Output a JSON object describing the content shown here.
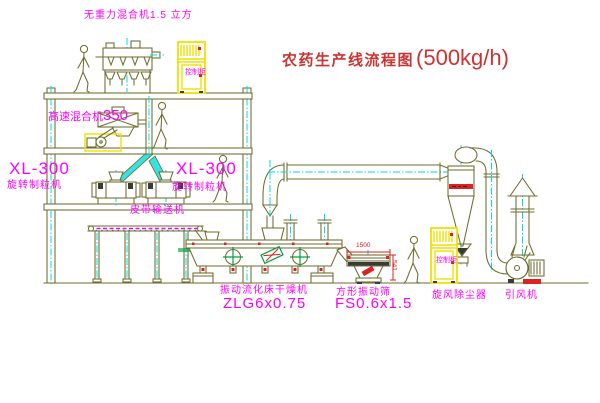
{
  "title": {
    "text": "农药生产线流程图",
    "capacity": "(500kg/h)"
  },
  "labels": {
    "gravity_mixer": "无重力混合机1.5 立方",
    "highspeed_mixer_name": "高速混合机",
    "highspeed_mixer_size": "350",
    "granulator_left_model": "XL-300",
    "granulator_left_name": "旋转制粒机",
    "granulator_center_model": "XL-300",
    "granulator_center_name": "旋转制粒机",
    "belt_conveyor": "皮带输送机",
    "dryer_name": "振动流化床干燥机",
    "dryer_model": "ZLG6x0.75",
    "sieve_name": "方形振动筛",
    "sieve_model": "FS0.6x1.5",
    "cyclone": "旋风除尘器",
    "induced_draft_fan": "引风机",
    "cabinet_top": "控制柜",
    "cabinet_bottom": "控制柜"
  },
  "dimensions": {
    "sieve_length": "1500",
    "sieve_height": "541"
  },
  "colors": {
    "line": "#6d6d2e",
    "centerline": "#00dcdc",
    "label_magenta": "#ff00ff",
    "title_red": "#cc3333",
    "cabinet_yellow": "#f0e000",
    "accent_red": "#dd2020",
    "accent_green": "#00a040"
  }
}
